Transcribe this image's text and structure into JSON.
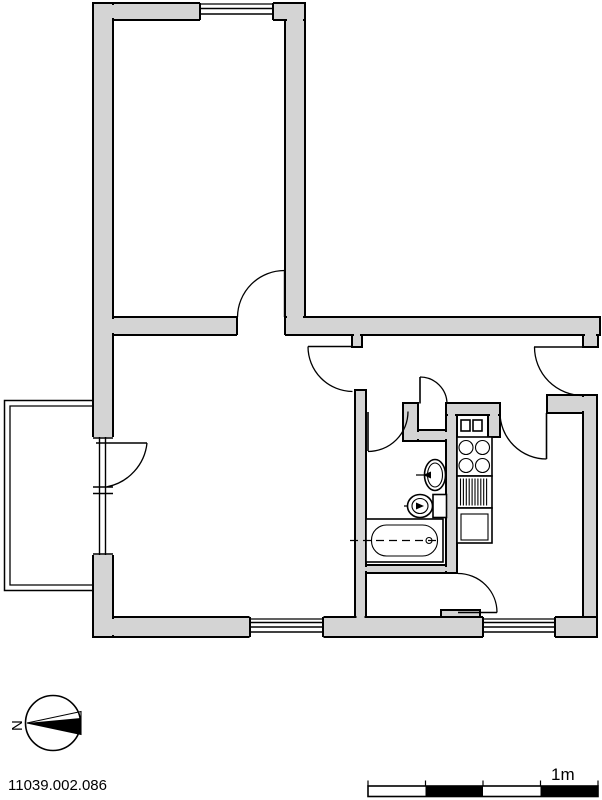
{
  "document": {
    "drawing_number": "11039.002.086"
  },
  "compass": {
    "north_label": "N"
  },
  "scale_bar": {
    "unit_label": "1m",
    "segment_count": 4,
    "segment_pattern": [
      "white",
      "black",
      "white",
      "black"
    ]
  },
  "colors": {
    "wall_fill": "#d4d4d4",
    "line": "#000000",
    "background": "#ffffff"
  },
  "fixtures": {
    "bathroom": [
      "washbasin",
      "toilet",
      "bathtub"
    ],
    "kitchen": [
      "ventilation-shaft",
      "ventilation-shaft",
      "stove-four-burners",
      "counter-drainer",
      "sink-unit"
    ]
  }
}
